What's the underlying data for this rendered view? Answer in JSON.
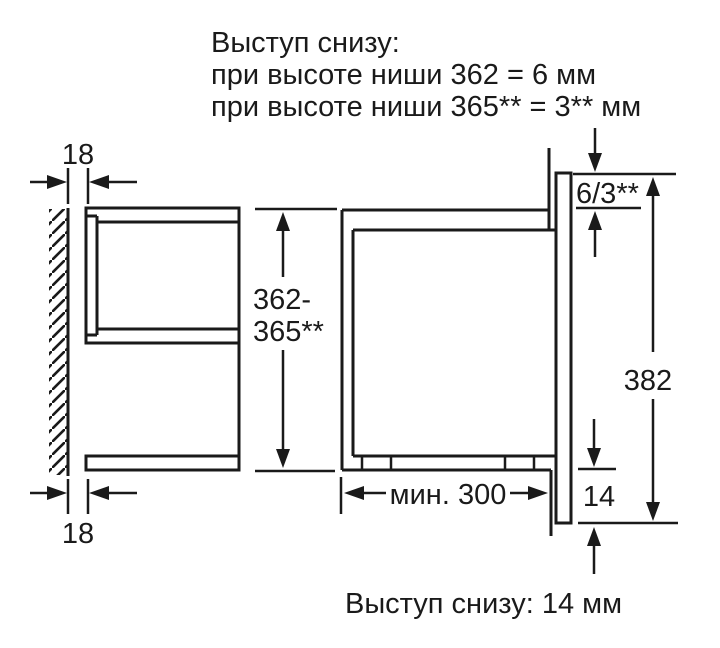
{
  "note_top": {
    "line1": "Выступ снизу:",
    "line2": "при высоте ниши 362 = 6 мм",
    "line3": "при высоте ниши 365** = 3** мм"
  },
  "dims": {
    "gap_top": "18",
    "gap_bottom": "18",
    "niche_height_1": "362-",
    "niche_height_2": "365**",
    "top_protrusion": "6/3**",
    "front_height": "382",
    "bottom_overhang": "14",
    "min_depth": "мин. 300"
  },
  "note_bottom": "Выступ снизу: 14 мм",
  "colors": {
    "ink": "#1a1a1a",
    "background": "#ffffff"
  }
}
